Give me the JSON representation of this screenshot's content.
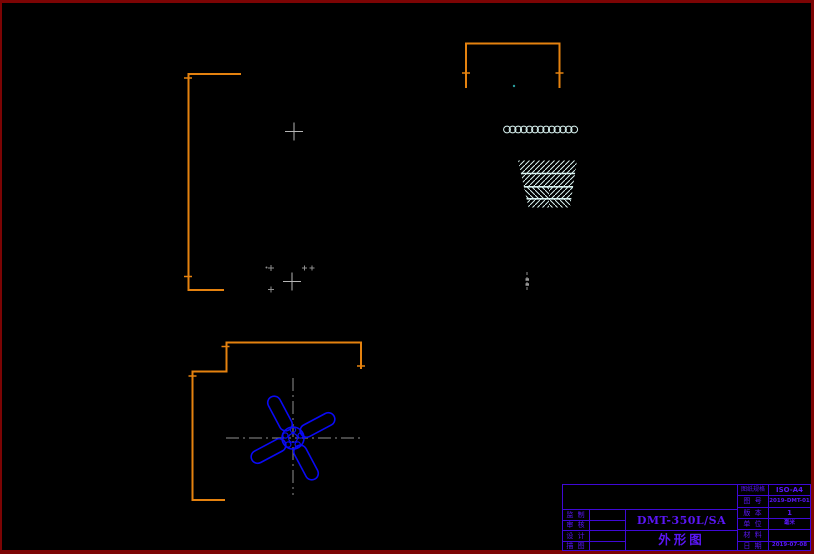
{
  "page": {
    "kind": "CAD outline drawing (外形图) of DMT-350L/SA",
    "colors": {
      "background": "#000000",
      "page_border": "#7c0404",
      "dimension": "#e5820f",
      "entity": "#0a0af5",
      "pale": "#d9f3f1",
      "centerline": "#8f8f8f",
      "title_line": "#3f08d6",
      "title_text": "#5a16f5"
    }
  },
  "title_block": {
    "company_cell": "",
    "left_rows": [
      {
        "label": "监 制",
        "value": ""
      },
      {
        "label": "审 核",
        "value": ""
      },
      {
        "label": "设 计",
        "value": ""
      },
      {
        "label": "描 图",
        "value": ""
      }
    ],
    "model_number": "DMT-350L/SA",
    "drawing_title": "外形图",
    "right_rows": [
      {
        "label": "图纸规格",
        "value": "ISO-A4"
      },
      {
        "label": "图 号",
        "value": "2019-DMT-01"
      },
      {
        "label": "版 本",
        "value": "1"
      },
      {
        "label": "单 位",
        "value": "毫米"
      },
      {
        "label": "材 料",
        "value": ""
      },
      {
        "label": "日 期",
        "value": "2019-07-08"
      }
    ]
  }
}
